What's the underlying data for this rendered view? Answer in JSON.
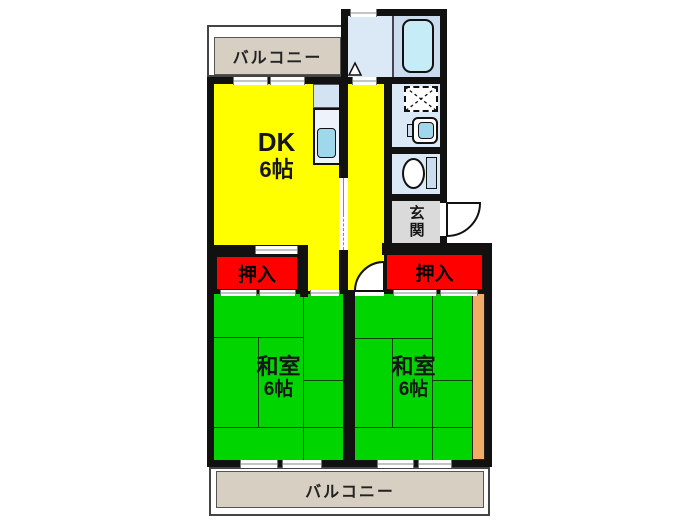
{
  "plan": {
    "type_note": "2DK apartment floor plan",
    "balcony_top": {
      "label": "バルコニー"
    },
    "balcony_bottom": {
      "label": "バルコニー"
    },
    "dk": {
      "name": "DK",
      "size": "6帖"
    },
    "washitsu_left": {
      "name": "和室",
      "size": "6帖"
    },
    "washitsu_right": {
      "name": "和室",
      "size": "6帖"
    },
    "closet_left": {
      "label": "押入"
    },
    "closet_right": {
      "label": "押入"
    },
    "entrance": {
      "label": "玄関"
    }
  },
  "fixtures": {
    "bathtub": "bathtub",
    "washing_machine_space": "washing-machine-space",
    "washbasin": "washbasin",
    "toilet": "toilet",
    "kitchen_counter": "kitchen-counter",
    "kitchen_sink": "kitchen-sink",
    "entry_door": "entry-door-swing",
    "room_door": "interior-door-swing",
    "sliding_door": "sliding-door",
    "door_marker": "door-swing-marker"
  },
  "colors": {
    "wall": "#111111",
    "dk-yellow": "#ffff00",
    "tatami-green": "#00d500",
    "closet-red": "#ff0000",
    "balcony-beige": "#d6cfc2",
    "genkan-gray": "#dadada",
    "wood-orange": "#f0ad6a",
    "blue-light": "#dbe8f5",
    "blue-mid": "#cbdcee",
    "tub-blue": "#c6ecf7",
    "sink-cyan": "#9ed8ea",
    "counter-blue": "#d3e3f2"
  }
}
